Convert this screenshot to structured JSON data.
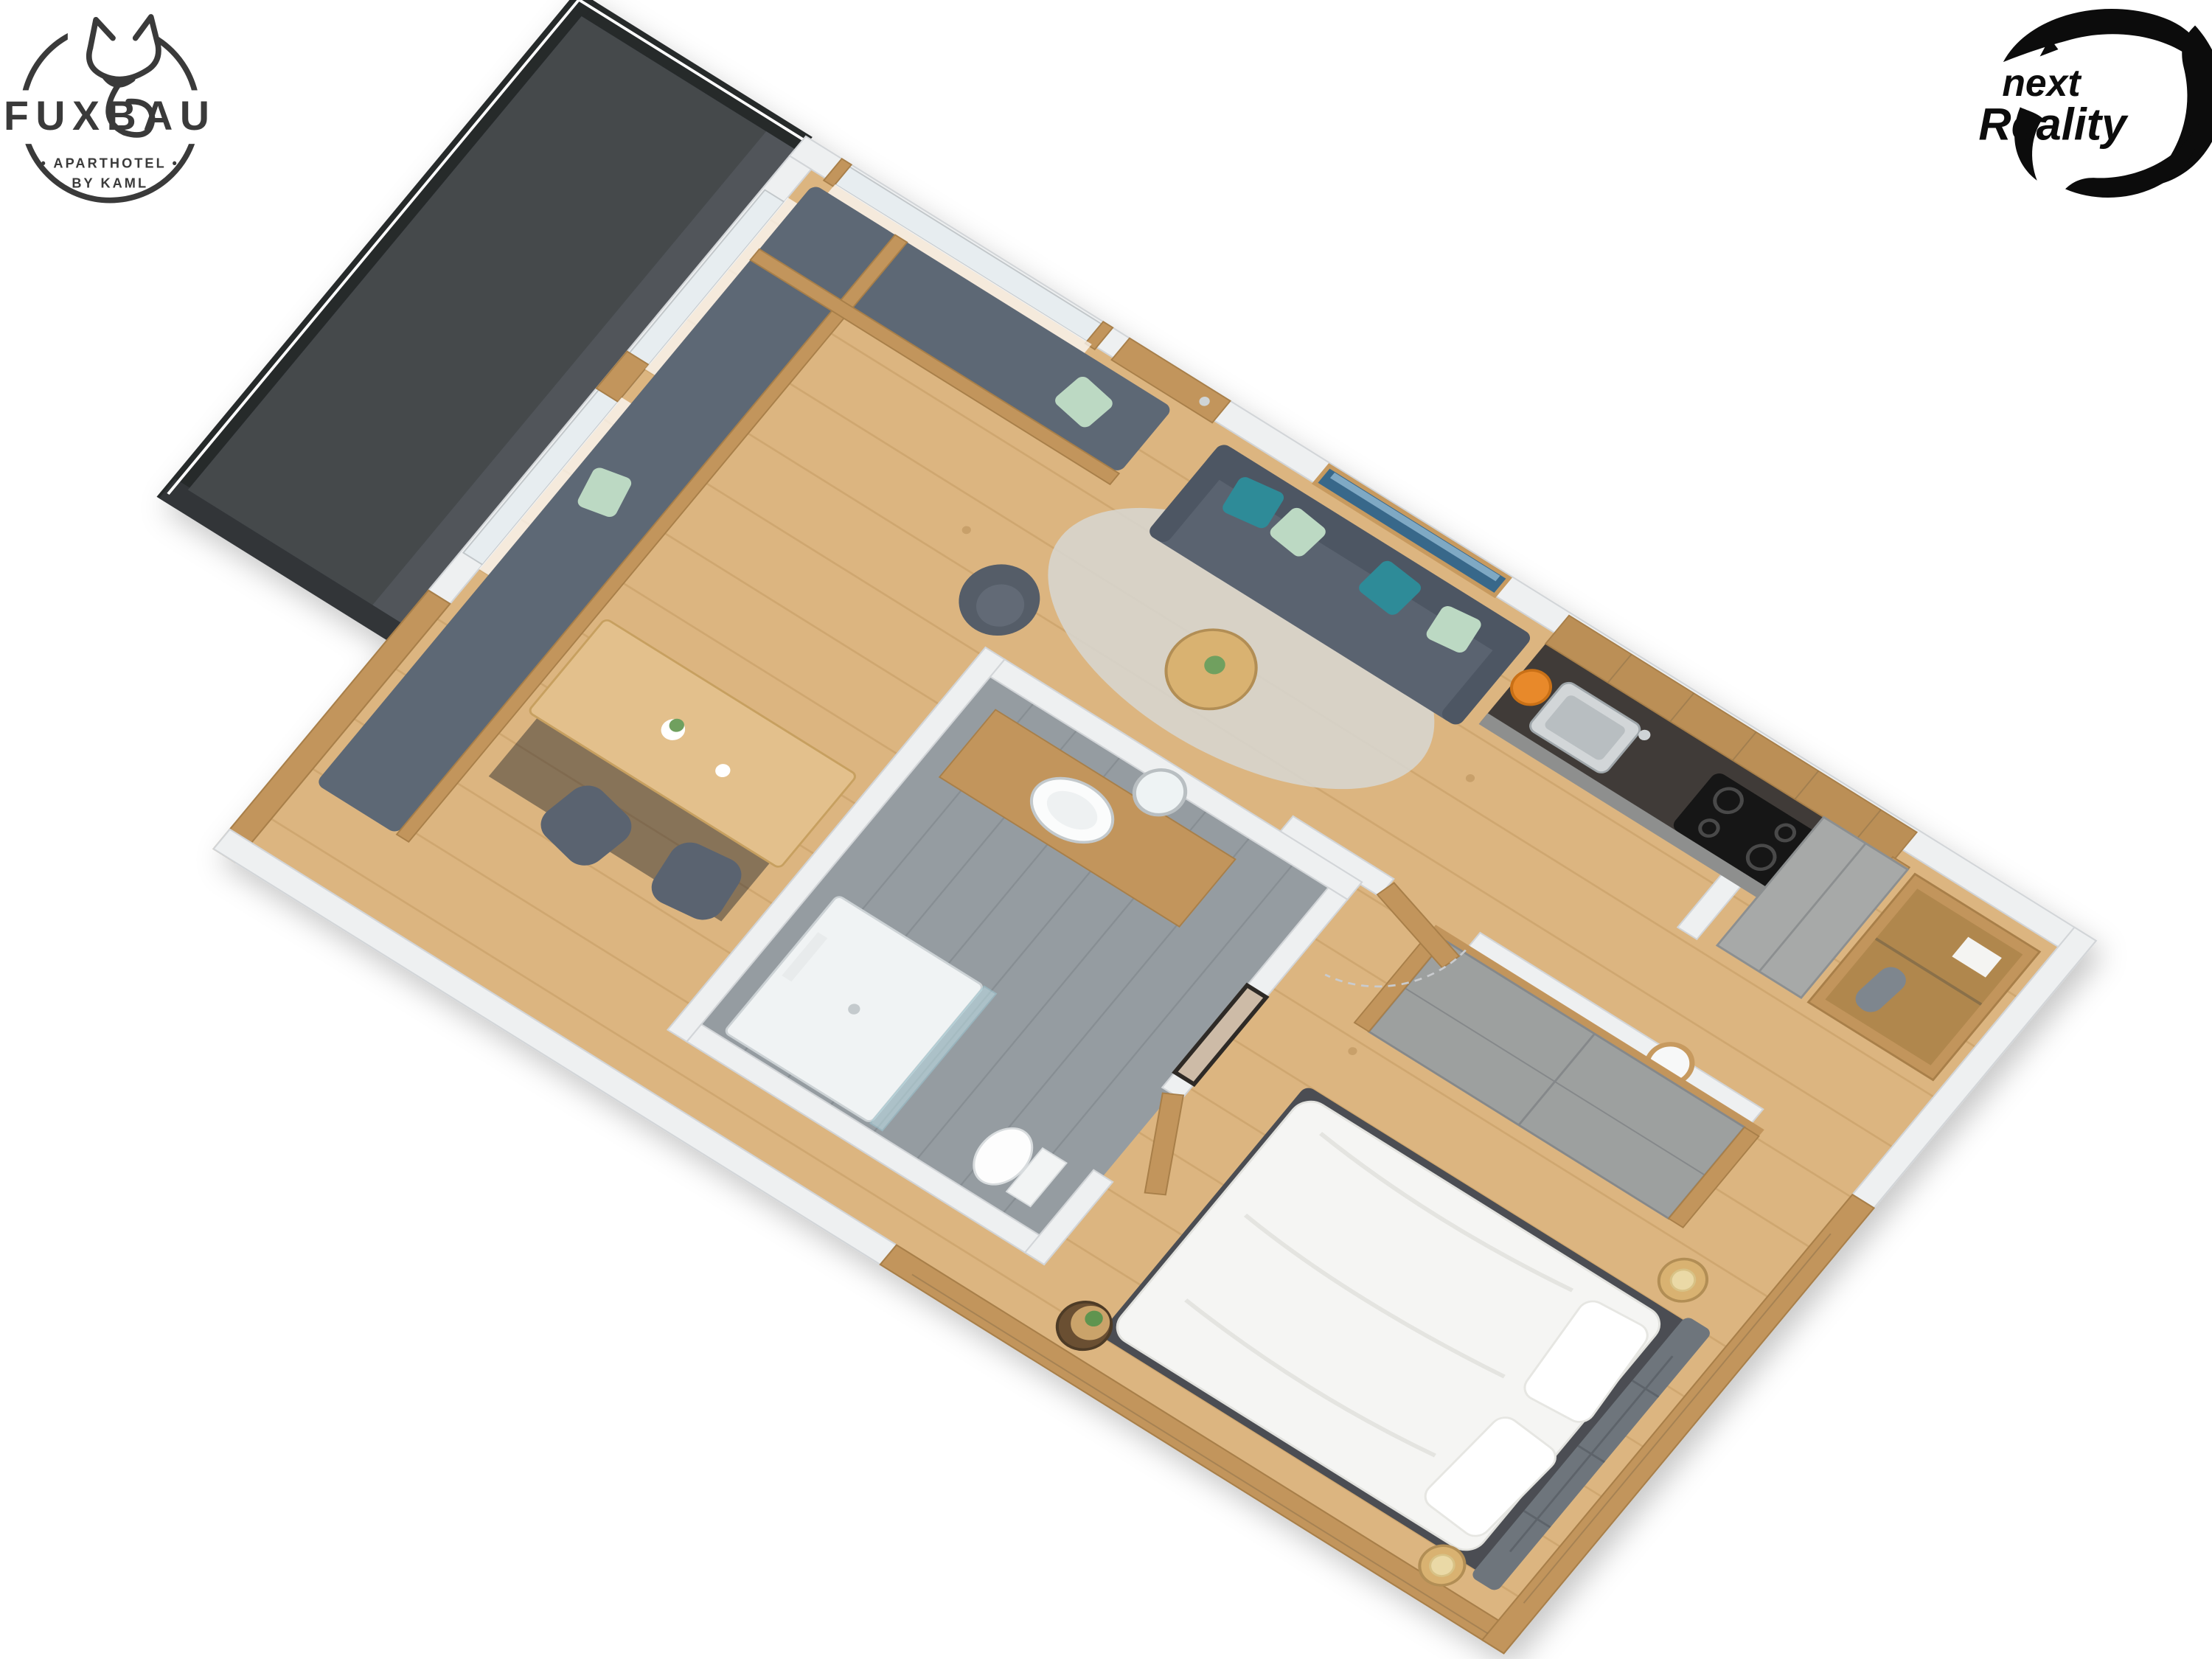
{
  "page": {
    "background_color": "#ffffff",
    "description": "3D isometric cutaway floor plan rendering of a one-bedroom aparthotel suite"
  },
  "branding": {
    "fuxbau_logo": {
      "brand": "FUXBAU",
      "tagline": "• APARTHOTEL •",
      "byline": "BY KAML",
      "icon": "fox-line-icon",
      "color": "#3a3a3a"
    },
    "next_reality_logo": {
      "word1": "next",
      "word2": "Reality",
      "icon": "vortex-swirl-icon",
      "color": "#0c0c0c"
    }
  },
  "floor_plan": {
    "view": "3d-isometric-cutaway",
    "rooms": [
      {
        "id": "balcony",
        "label": "balcony-terrace",
        "features": [
          "dark-deck",
          "railing-with-light-strip"
        ]
      },
      {
        "id": "living-dining",
        "label": "living-dining-area",
        "features": [
          "l-shaped-corner-bench",
          "mint-green-cushions",
          "wood-dining-table-with-flowers",
          "two-gray-chairs",
          "gray-sofa",
          "teal-cushions",
          "round-coffee-table",
          "gray-armchair",
          "area-rug",
          "panorama-mountain-artwork",
          "sheer-curtains",
          "wood-framed-windows",
          "entrance-door"
        ]
      },
      {
        "id": "kitchen",
        "label": "kitchenette",
        "features": [
          "rustic-wood-upper-cabinets",
          "dark-countertop",
          "stainless-sink",
          "induction-cooktop",
          "orange-fruit-bowl",
          "gray-base-cabinets"
        ]
      },
      {
        "id": "hall",
        "label": "entry-hall",
        "features": [
          "tall-gray-cabinet",
          "wood-coat-niche",
          "shelf-with-towels",
          "hanging-coat",
          "round-wood-mirror"
        ]
      },
      {
        "id": "bathroom",
        "label": "bathroom",
        "features": [
          "gray-tile-floor",
          "walk-in-shower",
          "glass-screen",
          "wood-vanity",
          "round-white-basin",
          "round-mirror",
          "wall-hung-toilet"
        ]
      },
      {
        "id": "bedroom",
        "label": "bedroom",
        "features": [
          "double-bed-white-duvet",
          "gray-upholstered-headboard",
          "white-pillows",
          "built-in-gray-wardrobe",
          "bedside-tables-with-cream-lamps",
          "log-side-table-with-plant",
          "framed-artwork",
          "wood-plank-walls"
        ]
      }
    ],
    "palette": {
      "wood_floor": "#dcb580",
      "wood_walls": "#c2955c",
      "white_walls": "#eef0f1",
      "bench_gray": "#5d6774",
      "sofa_gray": "#5a6370",
      "teal_accent": "#2f8b98",
      "mint_accent": "#bcd9c3",
      "tile_gray": "#959ca1",
      "balcony_dark": "#44484c",
      "counter_dark": "#3f3b37",
      "artwork_blue": "#39678a"
    }
  }
}
